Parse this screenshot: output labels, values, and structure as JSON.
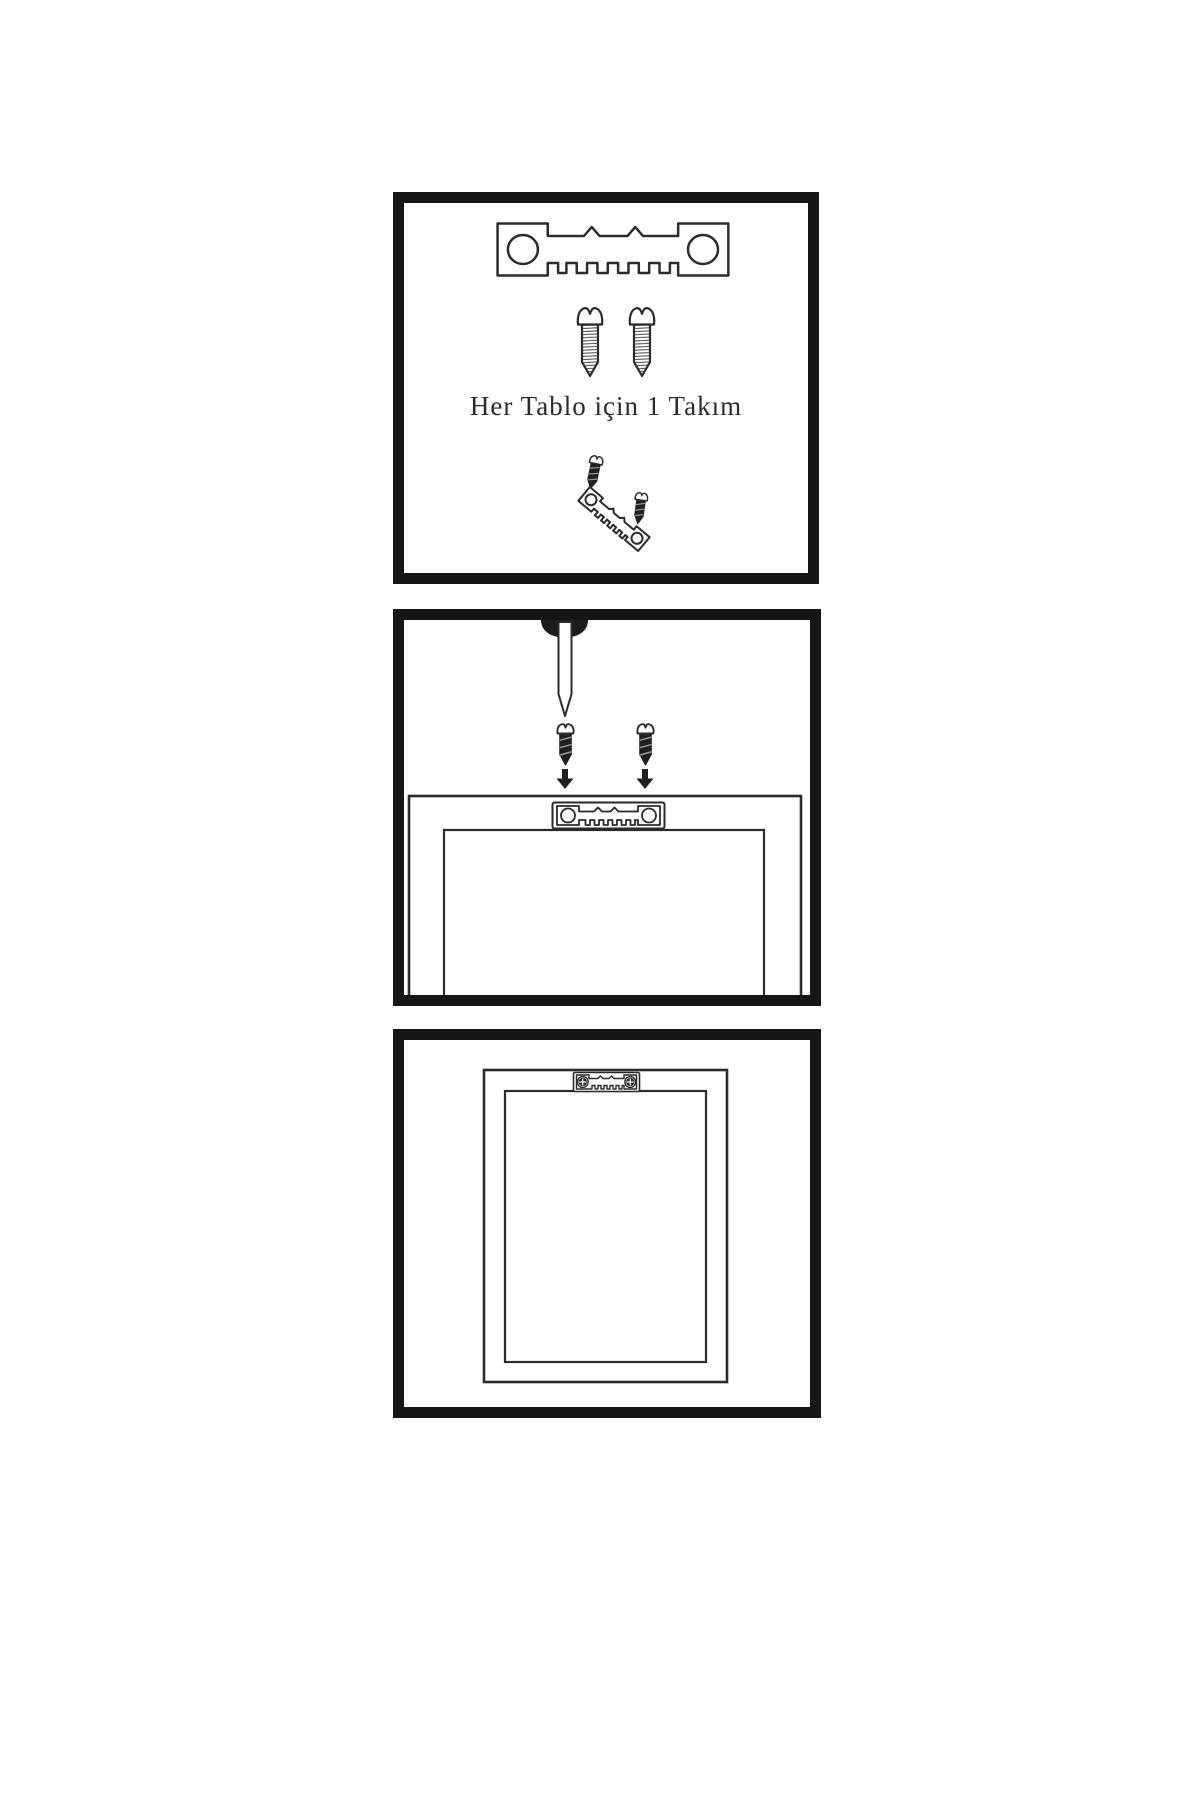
{
  "meta": {
    "description": "Illustrated three-step picture hanging instruction sheet (sawtooth hanger kit)"
  },
  "colors": {
    "background": "#ffffff",
    "panel_border": "#161616",
    "line": "#2b2b2b",
    "dark_fill": "#1f1f1f",
    "thread_line": "#555555"
  },
  "panels": [
    {
      "name": "hardware-kit",
      "caption": "Her Tablo için 1 Takım",
      "items": [
        "sawtooth-hanger",
        "screw",
        "screw",
        "assembled-hanger-with-screws"
      ]
    },
    {
      "name": "attach-hanger-to-frame-back",
      "items": [
        "wall-nail",
        "mounting-screw",
        "mounting-screw",
        "down-arrow",
        "down-arrow",
        "sawtooth-hanger-plate",
        "frame-back-top"
      ]
    },
    {
      "name": "hanger-mounted-on-frame",
      "items": [
        "frame-back",
        "mounted-sawtooth-hanger-with-phillips-screws"
      ]
    }
  ]
}
